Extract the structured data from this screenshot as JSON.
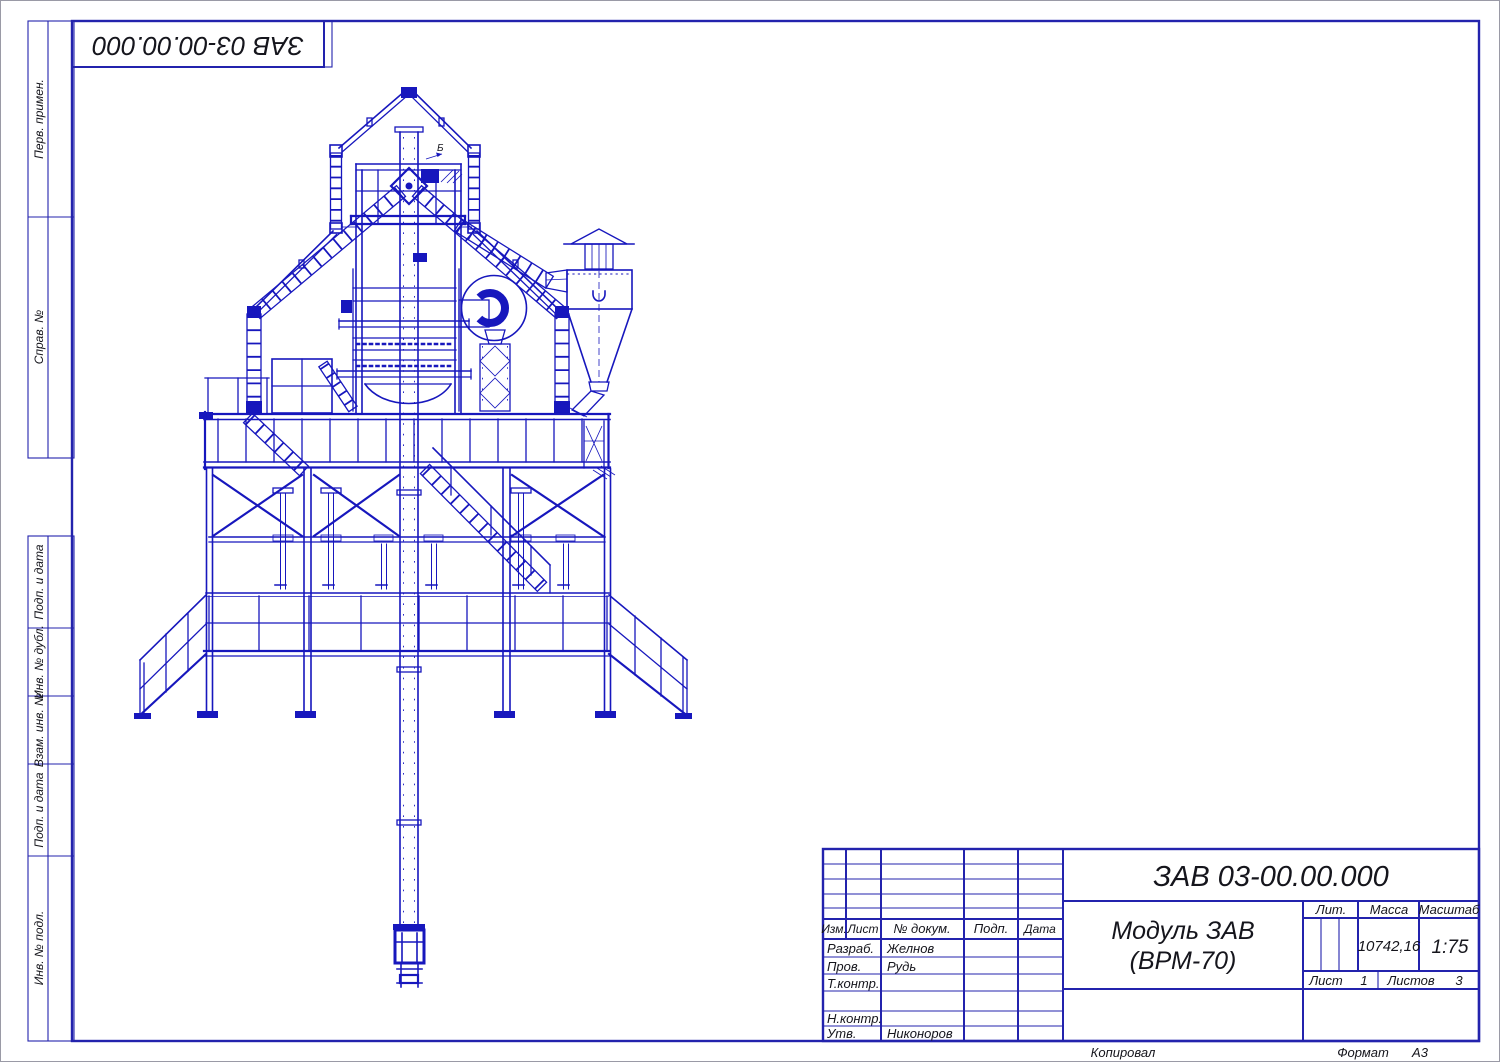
{
  "sheet": {
    "corner_designation": "ЗАВ 03-00.00.000",
    "footer": {
      "copied": "Копировал",
      "format_label": "Формат",
      "format_value": "А3"
    }
  },
  "margin_labels": {
    "perv_primen": "Перв. примен.",
    "sprav_no": "Справ. №",
    "podp_data_1": "Подп. и дата",
    "inv_no_dubl": "Инв. № дубл.",
    "vzam_inv_no": "Взам. инв. №",
    "podp_data_2": "Подп. и дата",
    "inv_no_podl": "Инв. № подл."
  },
  "title_block": {
    "designation": "ЗАВ 03-00.00.000",
    "title_line1": "Модуль ЗАВ",
    "title_line2": "(ВРМ-70)",
    "col_izm": "Изм.",
    "col_list": "Лист",
    "col_doc": "№ докум.",
    "col_podp": "Подп.",
    "col_data": "Дата",
    "razrab_label": "Разраб.",
    "razrab_name": "Желнов",
    "prov_label": "Пров.",
    "prov_name": "Рудь",
    "tkontr_label": "Т.контр.",
    "nkontr_label": "Н.контр.",
    "utv_label": "Утв.",
    "utv_name": "Никоноров",
    "lit_label": "Лит.",
    "massa_label": "Масса",
    "massa_value": "10742,16",
    "masshtab_label": "Масштаб",
    "masshtab_value": "1:75",
    "list_label": "Лист",
    "list_value": "1",
    "listov_label": "Листов",
    "listov_value": "3"
  },
  "drawing": {
    "section_mark": "Б",
    "line_color": "#1717bd",
    "table_line_color": "#2323ad",
    "text_color": "#15151c"
  }
}
